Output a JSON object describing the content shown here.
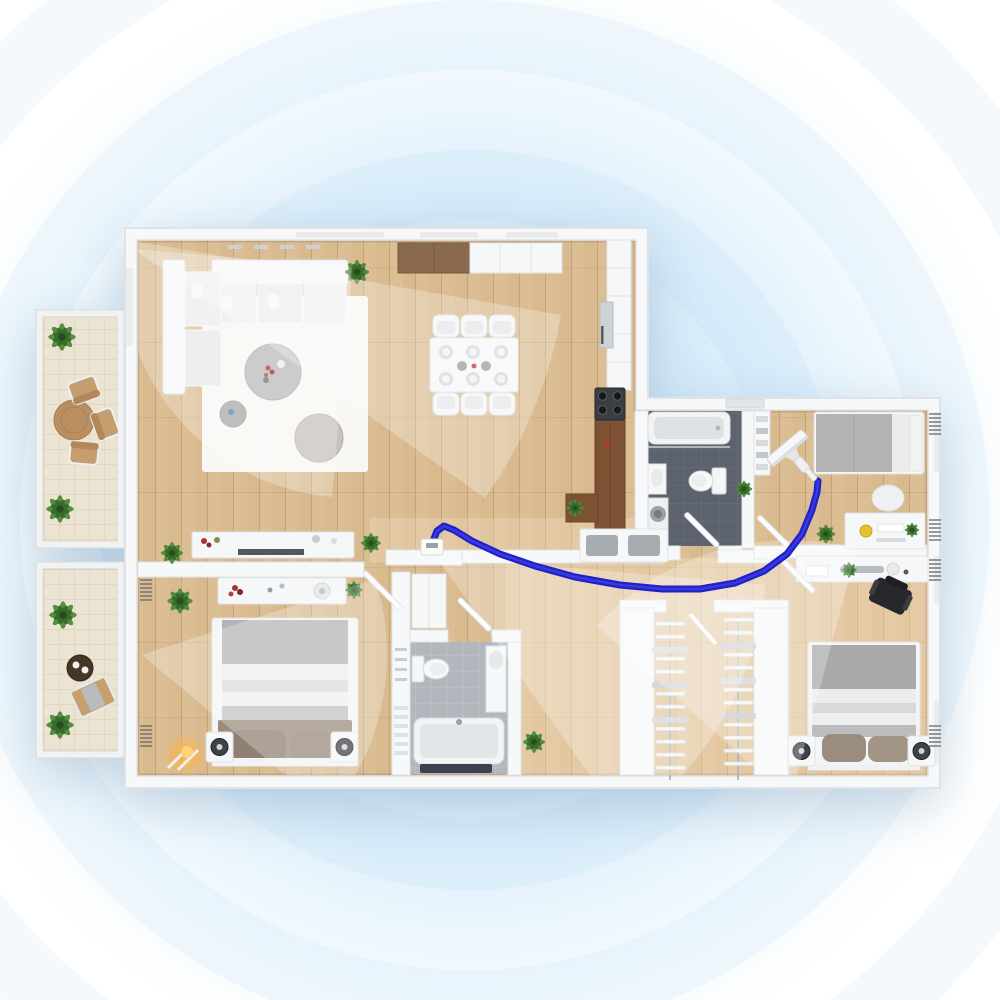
{
  "scene": {
    "type": "floor-plan-illustration",
    "style": "3d-top-down-apartment-render",
    "no_visible_text": true
  },
  "background": {
    "glow_center_x_pct": 47,
    "glow_center_y_pct": 52,
    "has_concentric_rings": true
  },
  "colors": {
    "bg_center": "#d3eafa",
    "wall": "#f7f8f9",
    "wall_line": "#dfe3e6",
    "white_furniture": "#f6f7f8",
    "wood": "#d9ba8e",
    "wood_dark": "#c7a476",
    "plank_line": "rgba(120,85,50,0.22)",
    "counter_wood": "#7c5134",
    "cabinet_brown": "#8a6a4e",
    "tile_balcony": "#ebe4d3",
    "tile_line": "#d5ccb6",
    "bath_dark_floor": "#5d636e",
    "bath_light_floor": "#b2b7bd",
    "stove_dark": "#3a3d43",
    "bed_gray": "#b4b4b6",
    "blanket_brown": "#9c8c7c",
    "plant_green": "#4c8a38",
    "plant_dark": "#35682a",
    "path_blue": "#2121c8",
    "lamp_glow": "#ffb347",
    "cone_fill": "rgba(255,255,255,0.27)"
  },
  "rooms": [
    {
      "id": "living-room",
      "furniture": [
        "corner-sofa",
        "rug",
        "coffee-table",
        "side-table",
        "pouf",
        "tv-console",
        "plants"
      ]
    },
    {
      "id": "dining-area",
      "furniture": [
        "dining-table",
        "chairs"
      ]
    },
    {
      "id": "kitchen",
      "furniture": [
        "upper-cabinets",
        "tall-cabinet-column",
        "oven",
        "cooktop",
        "wood-counter",
        "bar-with-plant"
      ]
    },
    {
      "id": "bathroom-main",
      "furniture": [
        "bathtub",
        "toilet",
        "sink",
        "washing-machine"
      ]
    },
    {
      "id": "bedroom-top-right",
      "furniture": [
        "double-bed",
        "desk",
        "chair",
        "desk-lamp",
        "plants",
        "shelf-column"
      ]
    },
    {
      "id": "hallway",
      "furniture": [
        "shoe-bench",
        "plants",
        "charging-dock"
      ]
    },
    {
      "id": "bedroom-bottom-left",
      "furniture": [
        "double-bed",
        "nightstand-speakers",
        "dresser",
        "floor-lamp",
        "plants"
      ]
    },
    {
      "id": "bathroom-small",
      "furniture": [
        "toilet",
        "vanity",
        "bathtub",
        "mat",
        "wardrobe"
      ]
    },
    {
      "id": "walk-in-closet",
      "furniture": [
        "clothes-rack-left",
        "clothes-rack-right"
      ]
    },
    {
      "id": "bedroom-bottom-right",
      "furniture": [
        "double-bed",
        "desk-shelf",
        "office-chair",
        "nightstand-speakers"
      ]
    },
    {
      "id": "balcony-top",
      "furniture": [
        "round-table",
        "three-chairs",
        "plants"
      ]
    },
    {
      "id": "balcony-bottom",
      "furniture": [
        "tray-table",
        "lounger",
        "plants"
      ]
    }
  ],
  "dining": {
    "chair_count": 6,
    "place_settings": 6
  },
  "closet": {
    "rack_count": 2,
    "hangers_per_rack": 12
  },
  "vacuum": {
    "kind": "stick-vacuum",
    "position_x": 794,
    "position_y": 456,
    "heading_deg": -40,
    "path_points": "432,551 433,541 437,531 444,526 454,530 472,541 500,554 535,566 575,577 620,585 662,589 700,589 735,583 764,571 787,554 802,534 812,510 817,492 818,481"
  },
  "dock": {
    "position_x": 421,
    "position_y": 539
  },
  "fov_cones": {
    "paths": [
      "M352,268 L332,497 A230,230 0 0 1 123,248 Z",
      "M118,238 L561,315 A450,450 0 0 1 485,498 Z",
      "M142,655 L375,579 A245,245 0 0 1 330,812 Z",
      "M436,556 L765,585 A330,330 0 0 1 625,826 Z",
      "M790,800 L597,626 A260,260 0 0 1 857,549 Z"
    ]
  }
}
